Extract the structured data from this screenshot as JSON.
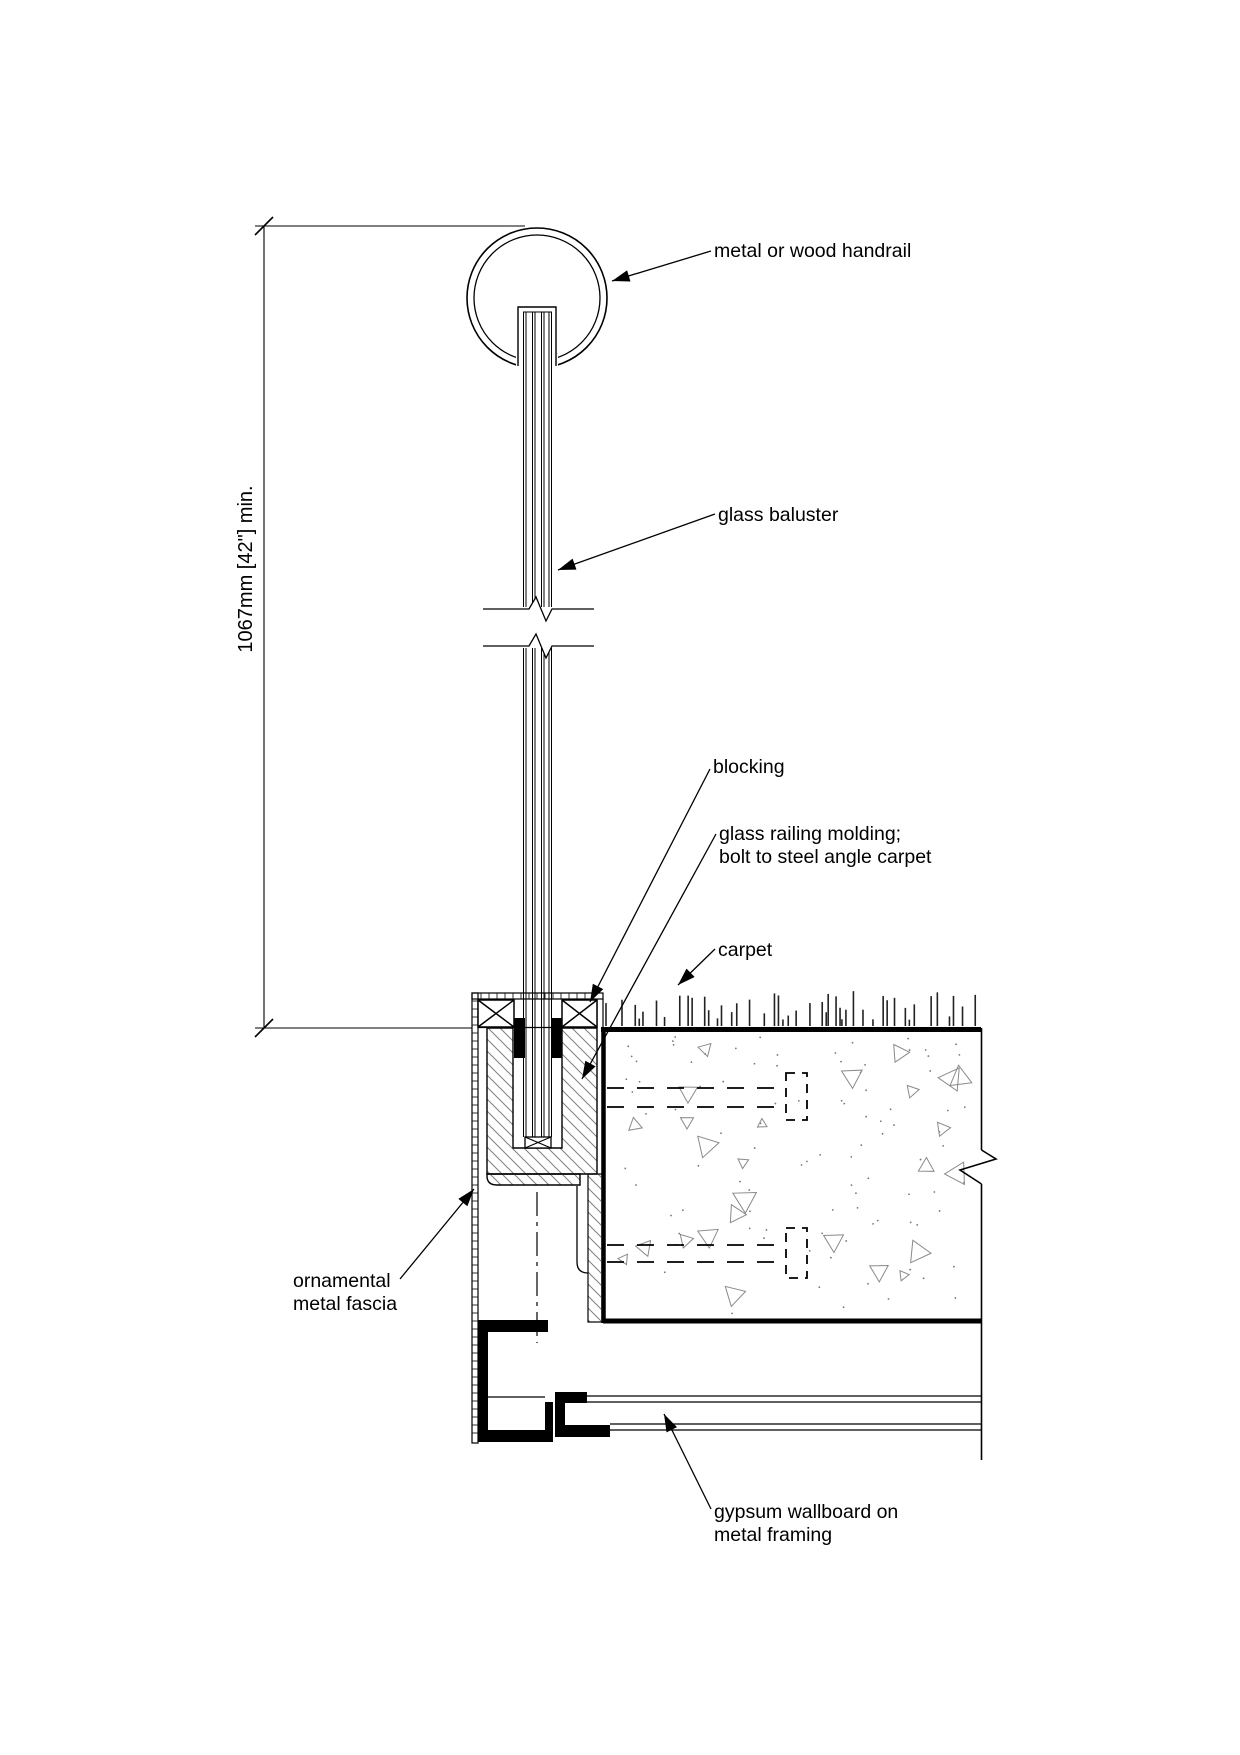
{
  "drawing": {
    "title": "glass baluster railing base detail",
    "labels": {
      "handrail": "metal or wood handrail",
      "baluster": "glass baluster",
      "blocking": "blocking",
      "molding_line1": "glass railing molding;",
      "molding_line2": "bolt to steel angle carpet",
      "carpet": "carpet",
      "fascia_line1": "ornamental",
      "fascia_line2": "metal fascia",
      "gypsum_line1": "gypsum wallboard on",
      "gypsum_line2": "metal framing",
      "dimension": "1067mm [42\"] min."
    },
    "colors": {
      "line": "#000000",
      "hatch": "#7f7f7f",
      "concrete_speckle": "#8a8a8a",
      "background": "#ffffff"
    }
  }
}
